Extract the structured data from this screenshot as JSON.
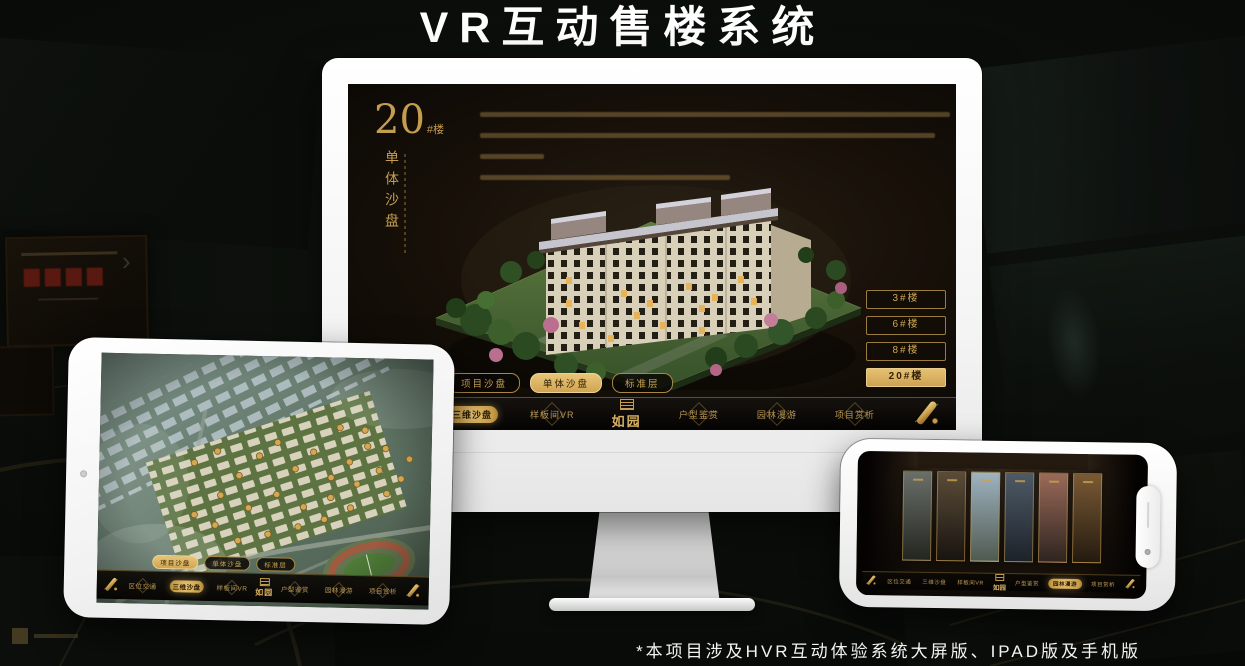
{
  "page": {
    "title": "VR互动售楼系统",
    "footnote": "*本项目涉及HVR互动体验系统大屏版、IPAD版及手机版"
  },
  "colors": {
    "gold": "#c59d4e",
    "gold_bright": "#e8c577",
    "active_text": "#2b1d06",
    "screen_bg": "#171009",
    "monitor_shell": "#ffffff"
  },
  "monitor": {
    "heading": {
      "number": "20",
      "suffix": "#楼",
      "vertical": "单体沙盘"
    },
    "building_buttons": [
      {
        "label": "3#楼"
      },
      {
        "label": "6#楼"
      },
      {
        "label": "8#楼"
      },
      {
        "label": "20#楼",
        "active": true
      }
    ],
    "tabs": [
      {
        "label": "项目沙盘"
      },
      {
        "label": "单体沙盘",
        "active": true
      },
      {
        "label": "标准层"
      }
    ],
    "nav": {
      "logo": "如园",
      "items_left": [
        {
          "label": "区位交通"
        },
        {
          "label": "三维沙盘",
          "active": true
        },
        {
          "label": "样板间VR"
        }
      ],
      "items_right": [
        {
          "label": "户型鉴赏"
        },
        {
          "label": "园林漫游"
        },
        {
          "label": "项目赏析"
        }
      ]
    }
  },
  "tablet": {
    "tabs": [
      {
        "label": "项目沙盘",
        "active": true
      },
      {
        "label": "单体沙盘"
      },
      {
        "label": "标准层"
      }
    ],
    "nav": {
      "logo": "如园",
      "items_left": [
        {
          "label": "区位交通"
        },
        {
          "label": "三维沙盘",
          "active": true
        },
        {
          "label": "样板间VR"
        }
      ],
      "items_right": [
        {
          "label": "户型鉴赏"
        },
        {
          "label": "园林漫游"
        },
        {
          "label": "项目赏析"
        }
      ]
    }
  },
  "phone": {
    "nav": {
      "logo": "如园",
      "items_left": [
        {
          "label": "区位交通"
        },
        {
          "label": "三维沙盘"
        },
        {
          "label": "样板间VR"
        }
      ],
      "items_right": [
        {
          "label": "户型鉴赏"
        },
        {
          "label": "园林漫游",
          "active": true
        },
        {
          "label": "项目赏析"
        }
      ]
    },
    "gallery": [
      {
        "c1": "#6a6f6a",
        "c2": "#23261f"
      },
      {
        "c1": "#5a4c38",
        "c2": "#191410"
      },
      {
        "c1": "#9fb3c0",
        "c2": "#4f5a50"
      },
      {
        "c1": "#4e5a66",
        "c2": "#1d222a"
      },
      {
        "c1": "#9a6a58",
        "c2": "#2e2420"
      },
      {
        "c1": "#7a5a34",
        "c2": "#241a10"
      }
    ]
  }
}
